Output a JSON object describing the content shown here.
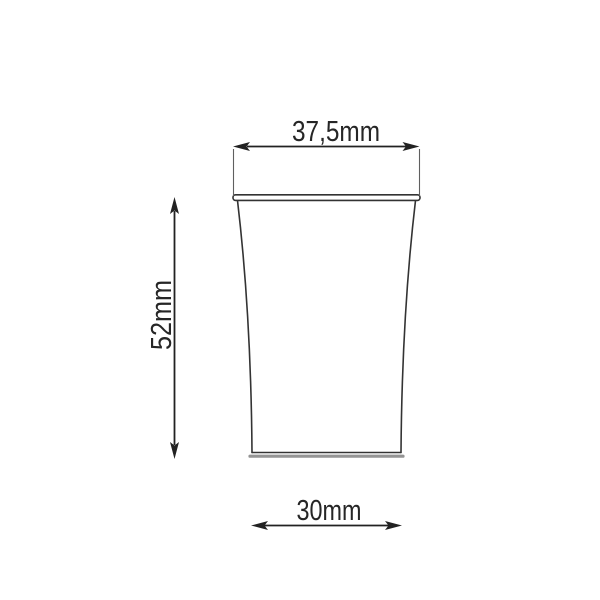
{
  "page": {
    "background": "#ffffff"
  },
  "drawing": {
    "labels": {
      "top_width": "37,5mm",
      "height": "52mm",
      "bottom_width": "30mm"
    },
    "colors": {
      "outline": "#333333",
      "dimension": "#222222",
      "extension": "#5f5f5f",
      "base_shadow": "#949494",
      "text": "#262626",
      "background": "#ffffff"
    }
  }
}
